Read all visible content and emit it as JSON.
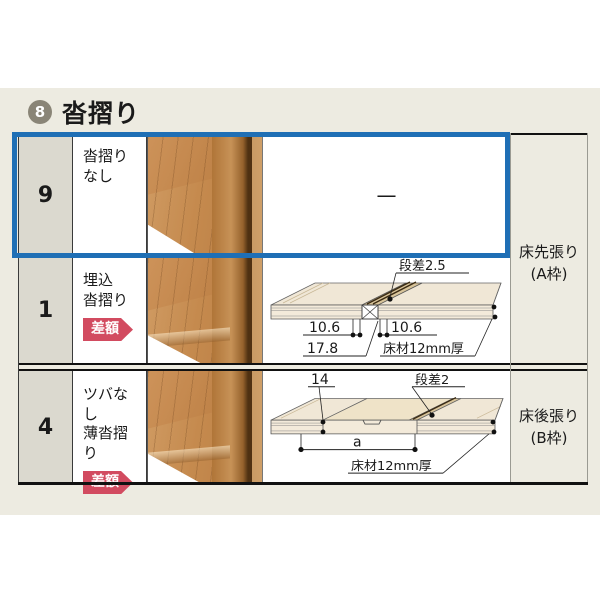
{
  "header": {
    "number": "8",
    "title": "沓摺り"
  },
  "colors": {
    "highlight": "#1F6FB5",
    "badge": "#D24B60",
    "circle": "#8A8577"
  },
  "table": {
    "rows": [
      {
        "id": "9",
        "label_line1": "沓摺り",
        "label_line2": "なし",
        "badge": ""
      },
      {
        "id": "1",
        "label_line1": "埋込",
        "label_line2": "沓摺り",
        "badge": "差額"
      },
      {
        "id": "4",
        "label_line1": "ツバなし",
        "label_line2": "薄沓摺り",
        "badge": "差額"
      }
    ],
    "row9_dash": "—",
    "frame_a_line1": "床先張り",
    "frame_a_line2": "(A枠)",
    "frame_b_line1": "床後張り",
    "frame_b_line2": "(B枠)",
    "diagram1": {
      "step": "段差2.5",
      "dim_left": "10.6",
      "dim_right": "10.6",
      "dim_total": "17.8",
      "floor": "床材12mm厚"
    },
    "diagram2": {
      "dim14": "14",
      "step": "段差2",
      "dim_a": "a",
      "floor": "床材12mm厚"
    }
  }
}
